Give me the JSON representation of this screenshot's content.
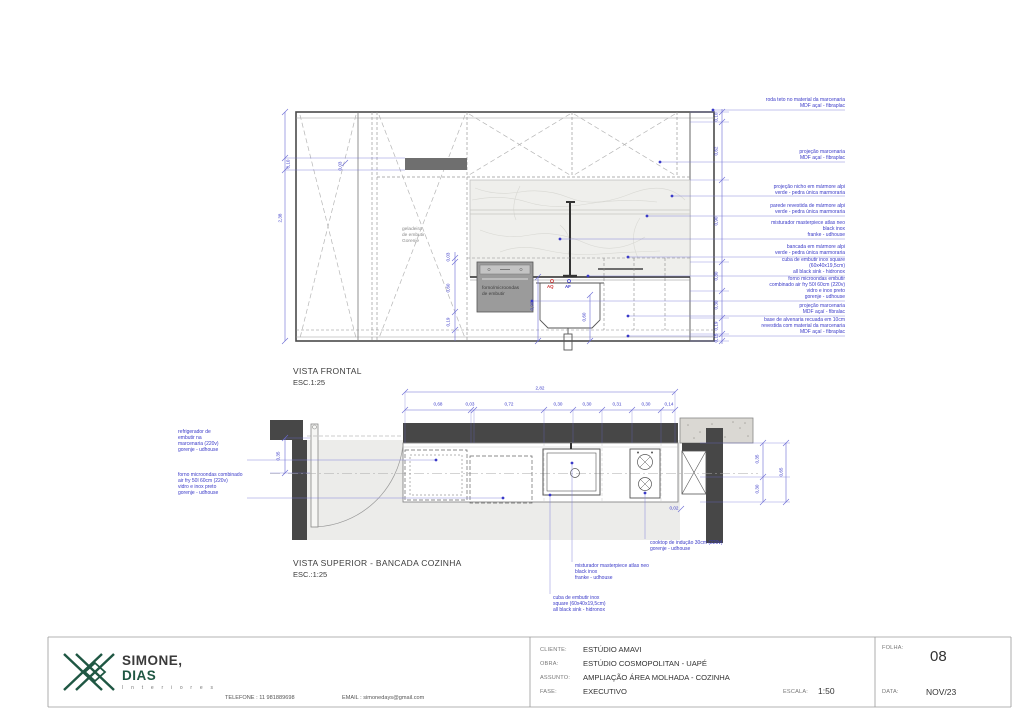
{
  "colors": {
    "annotation_blue": "#3a3ac8",
    "dim_blue": "#5a5ad0",
    "hot_water_red": "#cc3333",
    "wall_dark": "#474747",
    "logo_green": "#1f5743",
    "marble": "#efefec"
  },
  "frontal_view": {
    "title": "VISTA FRONTAL",
    "scale": "ESC.1:25",
    "labels": {
      "fridge": "geladeira\nde embutir\nGorenje",
      "oven": "forno/microondas\nde embutir",
      "hot_water": "AQ",
      "cold_water": "AF"
    },
    "annotations": [
      {
        "text": "roda teto no material da marcenaria\nMDF açaí - fibraplac"
      },
      {
        "text": "projeção marcenaria\nMDF açaí - fibraplac"
      },
      {
        "text": "projeção nicho em mármore alpi\nverde - pedra única marmoraria"
      },
      {
        "text": "parede revestida de mármore alpi\nverde - pedra única marmoraria"
      },
      {
        "text": "misturador masterpiece atlas neo\nblack inox\nfranke - udhouse"
      },
      {
        "text": "bancada em mármore alpi\nverde - pedra única marmoraria"
      },
      {
        "text": "cuba de embutir inox square\n(60x40x19,5cm)\nall black sink - hidronox"
      },
      {
        "text": "forno microondas embutir\ncombinado air fry 50l 60cm (220v)\nvidro e inox preto\ngorenje - udhouse"
      },
      {
        "text": "projeção marcenaria\nMDF açaí - fibralac"
      },
      {
        "text": "base de alvenaria recuada em 10cm\nrevestida com material da marcenaria\nMDF açaí - fibraplac"
      }
    ],
    "dims": {
      "total_height": "2,38",
      "shelf": "0,10",
      "gap": "0,03",
      "right_chain": [
        "0,10",
        "0,62",
        "0,90",
        "0,30",
        "0,30",
        "0,19",
        "0,15"
      ],
      "oven_chain": [
        "0,03",
        "0,60",
        "0,19"
      ],
      "sink_chain": [
        "0,90",
        "0,60"
      ]
    }
  },
  "superior_view": {
    "title": "VISTA SUPERIOR - BANCADA COZINHA",
    "scale": "ESC.:1:25",
    "annotations_left": [
      {
        "text": "refrigerador de\nembutir na\nmarcenaria (220v)\ngorenje - udhouse"
      },
      {
        "text": "forno microondas combinado\nair fry 50l 60cm (220v)\nvidro e inox preto\ngorenje - udhouse"
      }
    ],
    "annotations_bottom": [
      {
        "text": "cooktop de indução 30cm (220v)\ngorenje - udhouse"
      },
      {
        "text": "misturador masterpiece atlas neo\nblack inox\nfranke - udhouse"
      },
      {
        "text": "cuba de embutir inox\nsquare (60x40x19,5cm)\nall black sink - hidronox"
      }
    ],
    "dims": {
      "total_width": "2,82",
      "top_chain": [
        "0,68",
        "0,03",
        "0,72",
        "0,30",
        "0,30",
        "0,31",
        "0,30",
        "0,14"
      ],
      "right_chain": [
        "0,35",
        "0,30",
        "0,65"
      ],
      "left": "0,35",
      "cooktop_offset": "0,02"
    }
  },
  "titleblock": {
    "logo": {
      "line1": "SIMONE,",
      "line2": "DIAS",
      "line3": "I n t e r i o r e s"
    },
    "contact": {
      "telefone": "TELEFONE : 11 981889698",
      "email": "EMAIL : simonedays@gmail.com"
    },
    "fields": [
      {
        "label": "CLIENTE:",
        "value": "ESTÚDIO AMAVI"
      },
      {
        "label": "OBRA:",
        "value": "ESTÚDIO COSMOPOLITAN - UAPÉ"
      },
      {
        "label": "ASSUNTO:",
        "value": "AMPLIAÇÃO ÁREA MOLHADA - COZINHA"
      },
      {
        "label": "FASE:",
        "value": "EXECUTIVO"
      }
    ],
    "escala": {
      "label": "ESCALA:",
      "value": "1:50"
    },
    "folha": {
      "label": "FOLHA:",
      "value": "08"
    },
    "data": {
      "label": "DATA:",
      "value": "NOV/23"
    }
  }
}
